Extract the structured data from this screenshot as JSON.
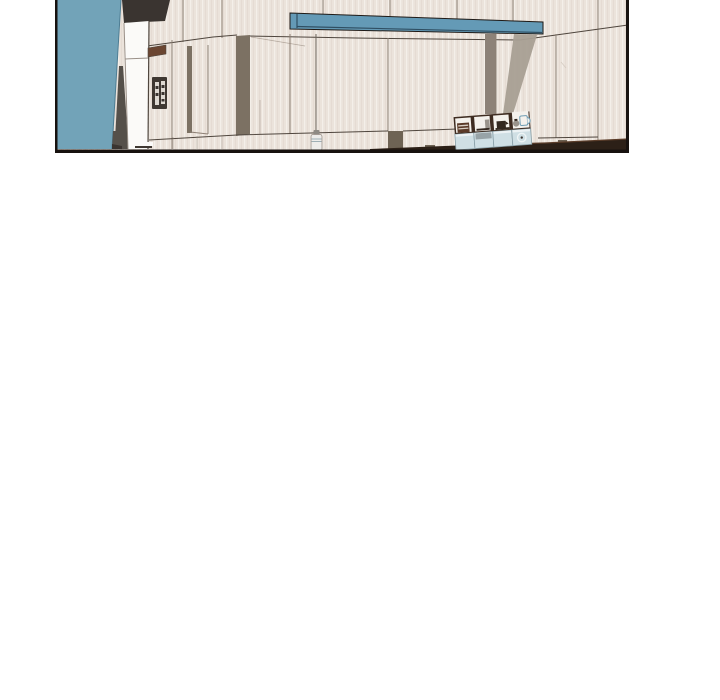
{
  "page": {
    "background": "#ffffff"
  },
  "panel": {
    "type": "comic-panel-illustration",
    "description": "Top strip of a 3D-rendered kitchen interior: teal accent wall on the left, tall white refrigerator with control pad, cream paneled walls, suspended blue shelf beam with grey supports, hanging pendant lamp, and a cubby shelf unit holding small appliances above pale blue drawers on a dark counter.",
    "x": 55,
    "y": 0,
    "width": 574,
    "height": 153,
    "colors": {
      "page_bg": "#ffffff",
      "border": "#17120f",
      "wall": "#ebe3db",
      "wall_stripe_dark": "#e0d5cb",
      "wall_stripe_light": "#f4efe9",
      "seam": "#8d8075",
      "seam_dark": "#4f463e",
      "teal": "#72a3b8",
      "teal_edge": "#4e7d93",
      "dark_box": "#3a3430",
      "fridge": "#fbfaf8",
      "fridge_line": "#9a9088",
      "handle": "#6b4632",
      "panel_dark": "#3f3832",
      "panel_light": "#ded9d2",
      "taupe": "#7c7163",
      "taupe_dark": "#6e6354",
      "beam": "#649ab6",
      "beam_dark": "#2f4f63",
      "beam_edge": "#1f1a16",
      "column": "#8d8278",
      "brace": "#a89f94",
      "cord": "#6b635a",
      "lamp": "#edecea",
      "lamp_grey": "#8e8a84",
      "counter": "#2c2017",
      "counter_brown": "#5a3c29",
      "cubby_frame": "#3e2c21",
      "cubby_white": "#f4f1ec",
      "appliance_red": "#5a3a28",
      "appliance_slat": "#d8cfc4",
      "appliance_grey": "#9a948c",
      "appliance_dark": "#33281f",
      "drawer": "#cfdfe4",
      "drawer_edge": "#8aa0a8",
      "drawer_top": "#eef4f5",
      "metal_grey": "#97a3a7",
      "mug_blue": "#6e9db4",
      "shadow_grey": "#55504a",
      "scratch": "#cfc5ba"
    }
  }
}
